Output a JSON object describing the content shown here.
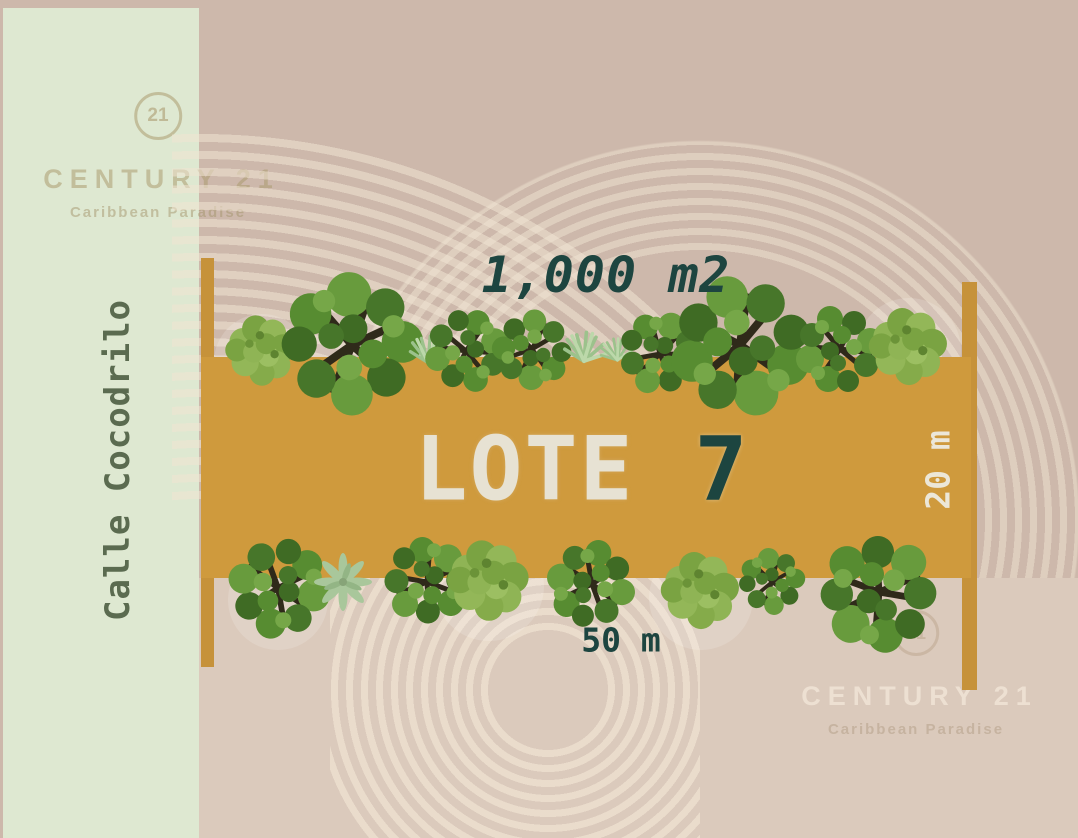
{
  "plan": {
    "street_label": "Calle Cocodrilo",
    "lot_label": "LOTE",
    "lot_number": "7",
    "area_label": "1,000 m2",
    "width_label": "50 m",
    "depth_label": "20 m"
  },
  "branding": {
    "logo_number": "21",
    "name": "CENTURY 21",
    "subtitle": "Caribbean Paradise"
  },
  "colors": {
    "lot_fill": "#cf9a3d",
    "lot_corner_marker": "#c6923a",
    "teal_text": "#1d4540",
    "cream_text": "#e7e2d3",
    "street_band_green": "#dee8d1",
    "background_tan": "#cdb8ab",
    "lower_band_beige": "#dbcabc",
    "street_text_green": "#5b6b50"
  }
}
